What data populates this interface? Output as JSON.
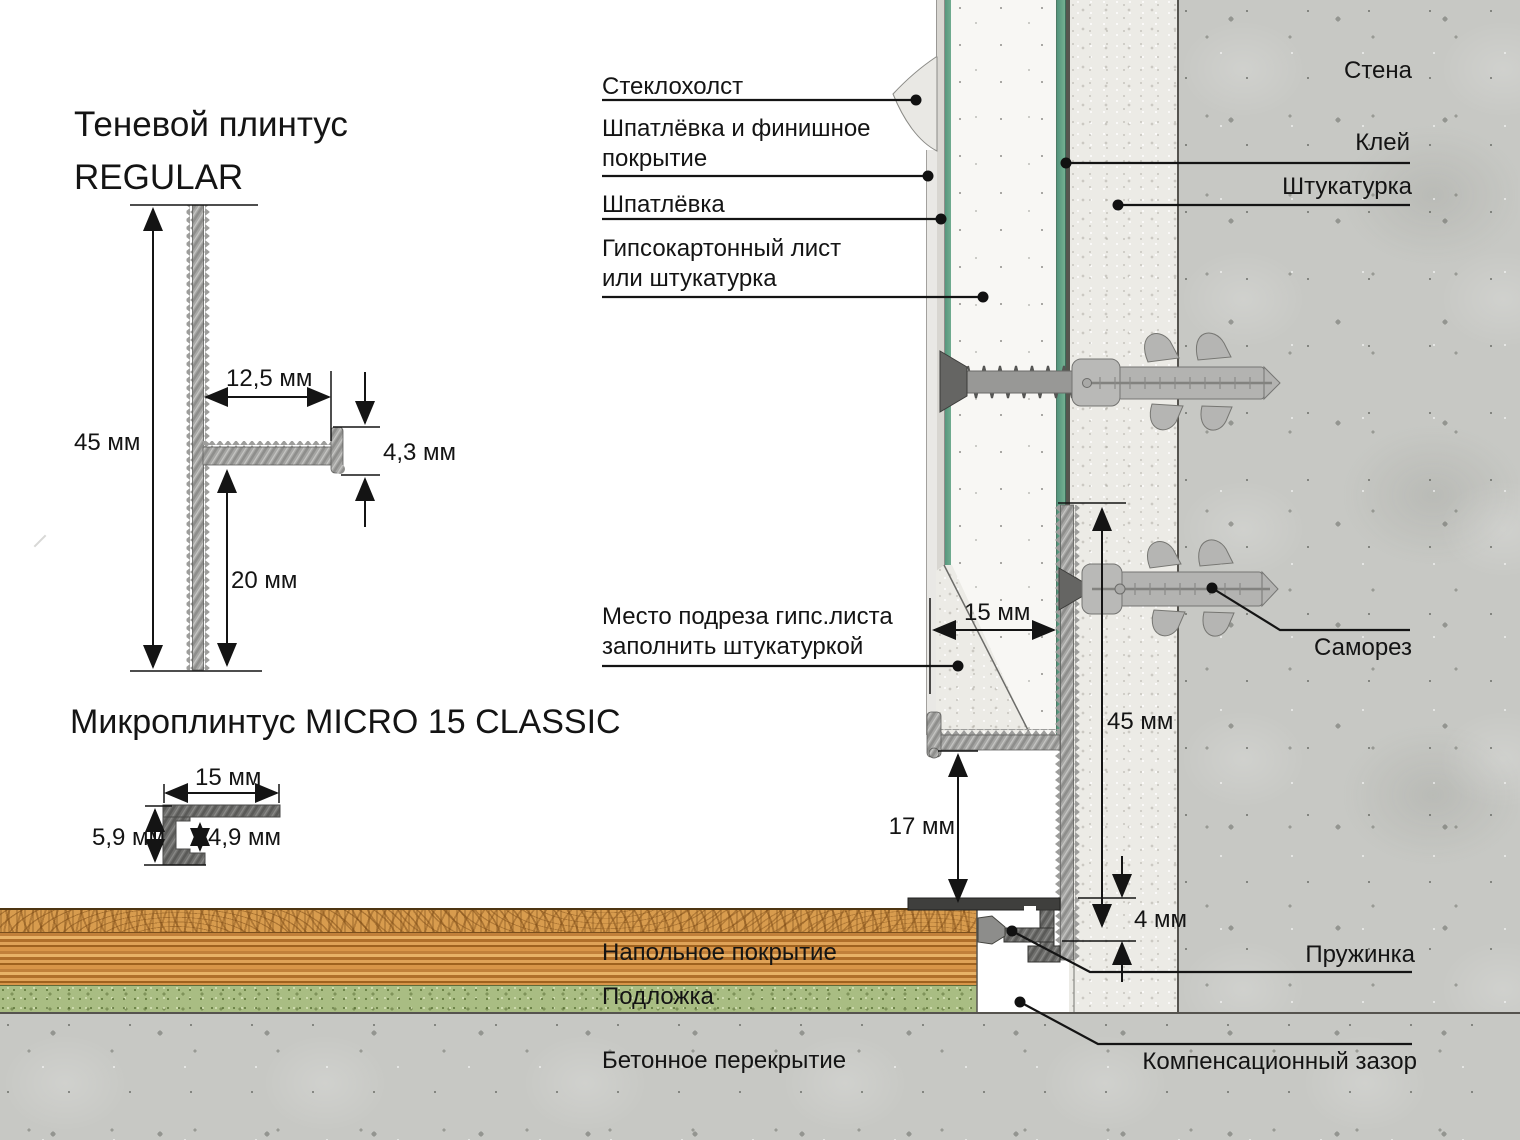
{
  "titles": {
    "regular": "Теневой плинтус\nREGULAR",
    "micro": "Микроплинтус MICRO 15 CLASSIC"
  },
  "regular_profile_dims": {
    "height": "45 мм",
    "flange_width": "12,5 мм",
    "lip_height": "4,3 мм",
    "bottom_leg": "20 мм"
  },
  "micro_profile_dims": {
    "width": "15 мм",
    "height": "5,9 мм",
    "inner_height": "4,9 мм"
  },
  "install_dims": {
    "cut_depth": "15 мм",
    "plinth_height": "45 мм",
    "shadow_gap": "17 мм",
    "floor_gap": "4 мм"
  },
  "labels": {
    "glass_fiber": "Стеклохолст",
    "putty_finish": "Шпатлёвка и финишное\nпокрытие",
    "putty": "Шпатлёвка",
    "gypsum_board": "Гипсокартонный лист\nили штукатурка",
    "cut_note": "Место подреза гипс.листа\nзаполнить штукатуркой",
    "floor_covering": "Напольное покрытие",
    "underlay": "Подложка",
    "concrete_slab": "Бетонное перекрытие",
    "wall": "Стена",
    "glue": "Клей",
    "plaster": "Штукатурка",
    "screw": "Саморез",
    "spring": "Пружинка",
    "compensation_gap": "Компенсационный зазор"
  },
  "colors": {
    "drywall_edge_green": "#5f9e82",
    "concrete": "#c7c8c4",
    "plaster": "#ecebe6",
    "wood": "#d0903f",
    "underlay_green": "#a9bd83",
    "metal": "#a6a6a4",
    "line": "#141414"
  }
}
